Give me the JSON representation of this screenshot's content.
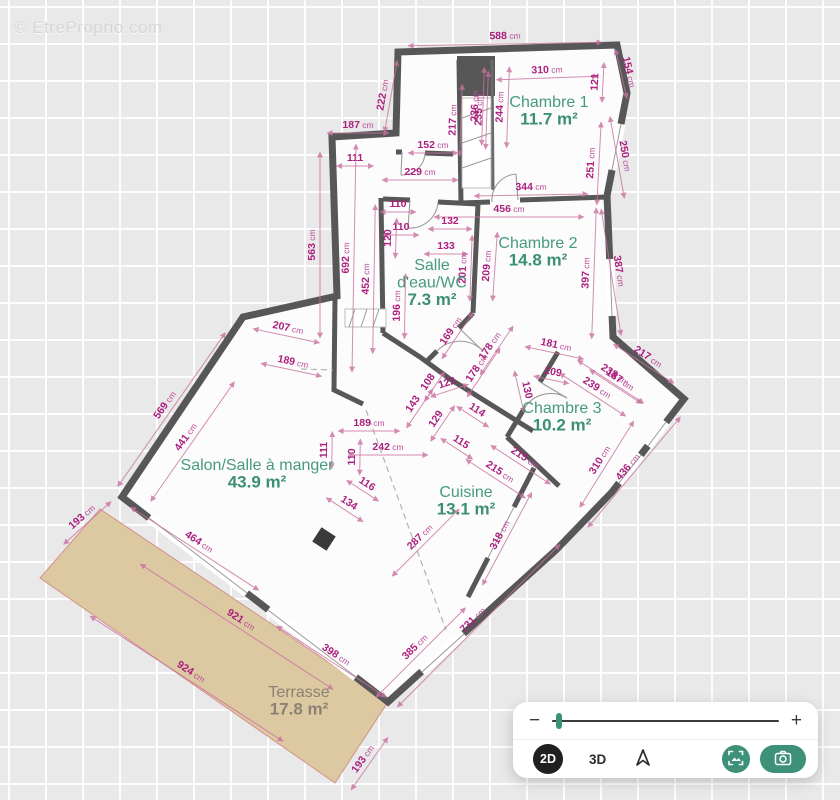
{
  "watermark": {
    "text": "© EtreProprio.com"
  },
  "plan": {
    "colors": {
      "wall": "#575757",
      "floor": "#fcfcfc",
      "terrace_fill": "#dcc9a2",
      "dimension_text": "#ac1f7e",
      "room_text": "#3b8f73",
      "terrace_text": "#8c8172",
      "accent": "#3e9179"
    },
    "rooms": [
      {
        "lines": [
          "Chambre 1"
        ],
        "area": "11.7 m²",
        "x": 549,
        "y": 107
      },
      {
        "lines": [
          "Chambre 2"
        ],
        "area": "14.8 m²",
        "x": 538,
        "y": 248
      },
      {
        "lines": [
          "Salle",
          "d'eau/WC"
        ],
        "area": "7.3 m²",
        "x": 432,
        "y": 270
      },
      {
        "lines": [
          "Chambre 3"
        ],
        "area": "10.2 m²",
        "x": 562,
        "y": 413
      },
      {
        "lines": [
          "Salon/Salle à manger"
        ],
        "area": "43.9 m²",
        "x": 257,
        "y": 470
      },
      {
        "lines": [
          "Cuisine"
        ],
        "area": "13.1 m²",
        "x": 466,
        "y": 497
      },
      {
        "lines": [
          "Terrasse"
        ],
        "area": "17.8 m²",
        "x": 299,
        "y": 697,
        "style": "terrace"
      }
    ],
    "dimensions": [
      {
        "v": "588",
        "u": "cm",
        "x": 505,
        "y": 36,
        "r": -1
      },
      {
        "v": "310",
        "u": "cm",
        "x": 547,
        "y": 70,
        "r": -2
      },
      {
        "v": "154",
        "u": "cm",
        "x": 629,
        "y": 72,
        "r": 77
      },
      {
        "v": "121",
        "u": "",
        "x": 595,
        "y": 82,
        "r": -87
      },
      {
        "v": "236",
        "u": "cm",
        "x": 475,
        "y": 106,
        "r": -88
      },
      {
        "v": "235",
        "u": "cm",
        "x": 479,
        "y": 110,
        "r": -88
      },
      {
        "v": "244",
        "u": "cm",
        "x": 500,
        "y": 107,
        "r": -88
      },
      {
        "v": "217",
        "u": "cm",
        "x": 453,
        "y": 120,
        "r": -88
      },
      {
        "v": "222",
        "u": "cm",
        "x": 383,
        "y": 95,
        "r": -80
      },
      {
        "v": "187",
        "u": "cm",
        "x": 358,
        "y": 125,
        "r": 0
      },
      {
        "v": "152",
        "u": "cm",
        "x": 433,
        "y": 145,
        "r": 0
      },
      {
        "v": "111",
        "u": "",
        "x": 355,
        "y": 158,
        "r": 0
      },
      {
        "v": "229",
        "u": "cm",
        "x": 420,
        "y": 172,
        "r": 0
      },
      {
        "v": "344",
        "u": "cm",
        "x": 531,
        "y": 187,
        "r": -1
      },
      {
        "v": "251",
        "u": "cm",
        "x": 591,
        "y": 163,
        "r": -87
      },
      {
        "v": "250",
        "u": "cm",
        "x": 625,
        "y": 156,
        "r": 80
      },
      {
        "v": "456",
        "u": "cm",
        "x": 509,
        "y": 209,
        "r": 0
      },
      {
        "v": "110",
        "u": "",
        "x": 398,
        "y": 204,
        "r": 0
      },
      {
        "v": "110",
        "u": "",
        "x": 401,
        "y": 227,
        "r": 0
      },
      {
        "v": "132",
        "u": "",
        "x": 450,
        "y": 221,
        "r": 0
      },
      {
        "v": "133",
        "u": "",
        "x": 446,
        "y": 246,
        "r": 0
      },
      {
        "v": "120",
        "u": "",
        "x": 388,
        "y": 238,
        "r": -88
      },
      {
        "v": "201",
        "u": "cm",
        "x": 463,
        "y": 268,
        "r": -88
      },
      {
        "v": "209",
        "u": "cm",
        "x": 487,
        "y": 266,
        "r": -86
      },
      {
        "v": "397",
        "u": "cm",
        "x": 586,
        "y": 273,
        "r": -88
      },
      {
        "v": "387",
        "u": "cm",
        "x": 619,
        "y": 271,
        "r": 81
      },
      {
        "v": "563",
        "u": "cm",
        "x": 312,
        "y": 245,
        "r": -90
      },
      {
        "v": "692",
        "u": "cm",
        "x": 346,
        "y": 258,
        "r": -89
      },
      {
        "v": "452",
        "u": "cm",
        "x": 366,
        "y": 279,
        "r": -89
      },
      {
        "v": "196",
        "u": "cm",
        "x": 397,
        "y": 306,
        "r": -89
      },
      {
        "v": "207",
        "u": "cm",
        "x": 288,
        "y": 328,
        "r": 12
      },
      {
        "v": "189",
        "u": "cm",
        "x": 293,
        "y": 362,
        "r": 12
      },
      {
        "v": "569",
        "u": "cm",
        "x": 165,
        "y": 405,
        "r": -55
      },
      {
        "v": "441",
        "u": "cm",
        "x": 186,
        "y": 437,
        "r": -55
      },
      {
        "v": "169",
        "u": "cm",
        "x": 451,
        "y": 331,
        "r": -56
      },
      {
        "v": "178",
        "u": "cm",
        "x": 490,
        "y": 346,
        "r": -56
      },
      {
        "v": "178",
        "u": "cm",
        "x": 477,
        "y": 368,
        "r": -56
      },
      {
        "v": "181",
        "u": "cm",
        "x": 556,
        "y": 345,
        "r": 12
      },
      {
        "v": "109",
        "u": "",
        "x": 553,
        "y": 372,
        "r": 12
      },
      {
        "v": "130",
        "u": "",
        "x": 527,
        "y": 390,
        "r": 77
      },
      {
        "v": "108",
        "u": "",
        "x": 428,
        "y": 382,
        "r": -56
      },
      {
        "v": "122",
        "u": "",
        "x": 447,
        "y": 383,
        "r": -18
      },
      {
        "v": "143",
        "u": "",
        "x": 413,
        "y": 404,
        "r": -56
      },
      {
        "v": "129",
        "u": "",
        "x": 436,
        "y": 419,
        "r": -56
      },
      {
        "v": "114",
        "u": "",
        "x": 477,
        "y": 410,
        "r": 33
      },
      {
        "v": "115",
        "u": "",
        "x": 461,
        "y": 442,
        "r": 33
      },
      {
        "v": "239",
        "u": "cm",
        "x": 597,
        "y": 388,
        "r": 33
      },
      {
        "v": "238",
        "u": "cm",
        "x": 615,
        "y": 375,
        "r": 33
      },
      {
        "v": "187",
        "u": "cm",
        "x": 620,
        "y": 380,
        "r": 33
      },
      {
        "v": "217",
        "u": "cm",
        "x": 648,
        "y": 357,
        "r": 33
      },
      {
        "v": "111",
        "u": "",
        "x": 324,
        "y": 450,
        "r": -89
      },
      {
        "v": "110",
        "u": "",
        "x": 352,
        "y": 457,
        "r": -89
      },
      {
        "v": "189",
        "u": "cm",
        "x": 369,
        "y": 423,
        "r": 0
      },
      {
        "v": "242",
        "u": "cm",
        "x": 388,
        "y": 447,
        "r": 0
      },
      {
        "v": "116",
        "u": "",
        "x": 367,
        "y": 484,
        "r": 33
      },
      {
        "v": "134",
        "u": "",
        "x": 349,
        "y": 503,
        "r": 33
      },
      {
        "v": "215",
        "u": "cm",
        "x": 525,
        "y": 458,
        "r": 33
      },
      {
        "v": "215",
        "u": "cm",
        "x": 500,
        "y": 472,
        "r": 33
      },
      {
        "v": "310",
        "u": "cm",
        "x": 600,
        "y": 460,
        "r": -58
      },
      {
        "v": "436",
        "u": "cm",
        "x": 628,
        "y": 467,
        "r": -50
      },
      {
        "v": "287",
        "u": "cm",
        "x": 420,
        "y": 537,
        "r": -45
      },
      {
        "v": "318",
        "u": "cm",
        "x": 500,
        "y": 535,
        "r": -62
      },
      {
        "v": "464",
        "u": "cm",
        "x": 199,
        "y": 542,
        "r": 33
      },
      {
        "v": "921",
        "u": "cm",
        "x": 241,
        "y": 620,
        "r": 33
      },
      {
        "v": "924",
        "u": "cm",
        "x": 191,
        "y": 672,
        "r": 33
      },
      {
        "v": "398",
        "u": "cm",
        "x": 336,
        "y": 655,
        "r": 33
      },
      {
        "v": "385",
        "u": "cm",
        "x": 415,
        "y": 647,
        "r": -45
      },
      {
        "v": "731",
        "u": "cm",
        "x": 473,
        "y": 620,
        "r": -45
      },
      {
        "v": "193",
        "u": "cm",
        "x": 82,
        "y": 517,
        "r": -42
      },
      {
        "v": "193",
        "u": "cm",
        "x": 363,
        "y": 759,
        "r": -55
      }
    ]
  },
  "toolbar": {
    "zoom_out": "−",
    "zoom_in": "+",
    "slider_pos_pct": 3,
    "mode_2d": "2D",
    "mode_3d": "3D",
    "icons": [
      "north-arrow-icon",
      "screenshot-icon",
      "camera-icon"
    ]
  }
}
